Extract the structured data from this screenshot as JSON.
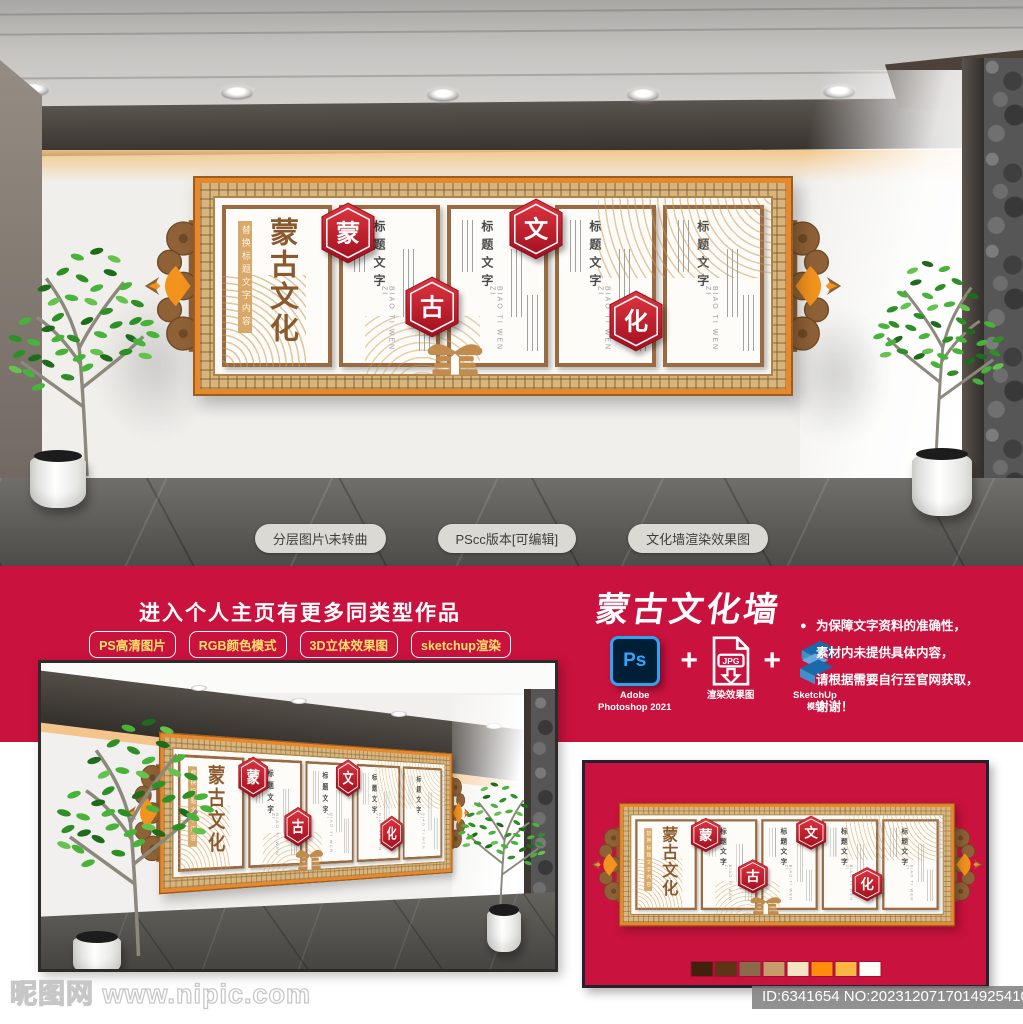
{
  "colors": {
    "banner_red": "#c9123d",
    "badge_red": "#c4182b",
    "frame_orange": "#e8872b",
    "frame_gold": "#d6b67e",
    "wood_brown": "#9a6b42",
    "calligraphy_brown": "#8a5a2e",
    "pill_text_yellow": "#ffe26a"
  },
  "render": {
    "floor_pills": [
      "分层图片\\未转曲",
      "PScc版本[可编辑]",
      "文化墙渲染效果图"
    ]
  },
  "wall": {
    "calligraphy_title": "蒙古文化",
    "replace_note": "替换标题文字内容",
    "badges": [
      "蒙",
      "古",
      "文",
      "化"
    ],
    "panel_title": "标题文字",
    "panel_pinyin": "BIAO TI WEN ZI"
  },
  "promo": {
    "headline": "进入个人主页有更多同类型作品",
    "feature_pills": [
      "PS高清图片",
      "RGB颜色模式",
      "3D立体效果图",
      "sketchup渲染"
    ],
    "product_title": "蒙古文化墙",
    "notice_bullet": "●",
    "notice_lines": [
      "为保障文字资料的准确性，",
      "素材内未提供具体内容，",
      "请根据需要自行至官网获取，",
      "谢谢！"
    ],
    "tools": {
      "ps_glyph": "Ps",
      "ps_name_1": "Adobe",
      "ps_name_2": "Photoshop 2021",
      "plus": "+",
      "jpg_glyph": "JPG",
      "jpg_name": "渲染效果图",
      "su_name_1": "SketchUp",
      "su_name_2": "模型"
    }
  },
  "swatches": [
    "#42210b",
    "#5f3413",
    "#8a6a4a",
    "#c79c6a",
    "#f4e4c2",
    "#ff8e0d",
    "#f9b645",
    "#fffdf4"
  ],
  "footer": {
    "watermark": "昵图网 www.nipic.com",
    "id_label": "ID:6341654 NO:20231207170149254109"
  }
}
